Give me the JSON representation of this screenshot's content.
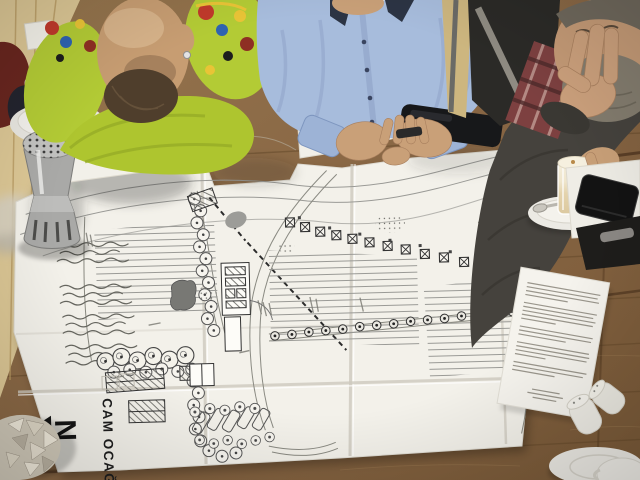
{
  "scene": {
    "type": "photograph",
    "description": "Overhead view of three men at a wooden cafe table studying a large folded architectural site plan; coffee, a steel thermos, a pencil, a smartphone and printed documents lie around the drawing."
  },
  "site_plan": {
    "site_label": "CAM OCAĞI",
    "north_label": "N"
  },
  "objects": {
    "pen": "mechanical-pencil",
    "phone": "black-smartphone",
    "thermos": "perforated-steel-thermos",
    "tea_cup": "white-cup-and-saucer",
    "latte": "latte-macchiato-glass-on-saucer",
    "wallet": "black-leather-case",
    "folder": "black-folder",
    "document": "printed-a4-page",
    "napkin": "crumpled-napkin",
    "espresso": "espresso-cup-and-saucer",
    "shakers": "two-ceramic-shakers"
  },
  "people": [
    {
      "position": "left",
      "appearance": "bald man with dark beard, lime-green patterned sweater, arms folded over the plan"
    },
    {
      "position": "center",
      "appearance": "man in light-blue dress shirt, hands clasped, smartphone beside him"
    },
    {
      "position": "right",
      "appearance": "grey-bearded man in dark sweater and plaid scarf, hand on chin, holding a latte"
    }
  ],
  "colors": {
    "table_wood": "#8a6a45",
    "floor_wood": "#dcc795",
    "plan_paper": "#f3f1ea",
    "plan_ink": "#3c3c3c",
    "sweater_green": "#b3cb35",
    "shirt_blue": "#a7bcdc",
    "dark_sweater": "#45423d",
    "skin": "#c79d72",
    "jacket_red": "#69261f"
  }
}
